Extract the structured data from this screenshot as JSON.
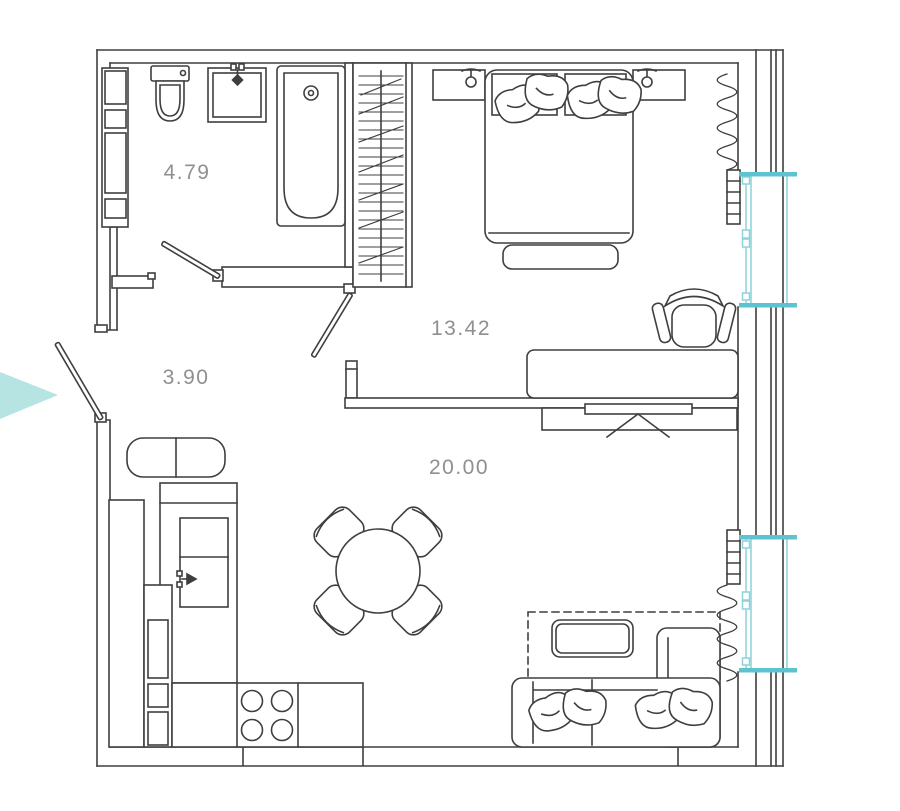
{
  "rooms": {
    "bathroom": {
      "area": "4.79"
    },
    "hallway": {
      "area": "3.90"
    },
    "bedroom": {
      "area": "13.42"
    },
    "living_kitchen": {
      "area": "20.00"
    }
  },
  "colors": {
    "line": "#3f3f3f",
    "label": "#8f8f8f",
    "window_frame": "#8ed2da",
    "window_sill": "#5fc3cf",
    "entrance_arrow": "#b5e4e3",
    "background": "#ffffff"
  }
}
